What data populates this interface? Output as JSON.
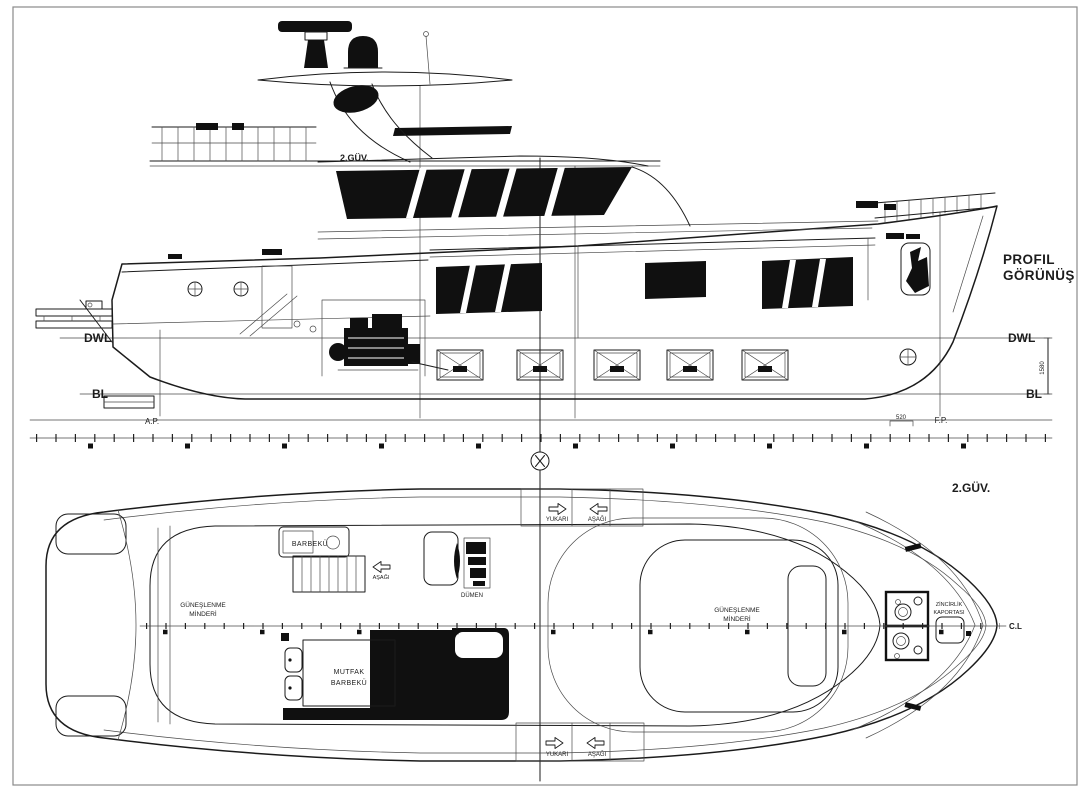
{
  "profile": {
    "title_line1": "PROFIL",
    "title_line2": "GÖRÜNÜŞ",
    "deck2_label": "2.GÜV.",
    "dwl_left": "DWL",
    "dwl_right": "DWL",
    "bl_left": "BL",
    "bl_right": "BL",
    "ap_label": "A.P.",
    "fp_label": "F.P.",
    "dim_forward": "520",
    "dim_depth": "1580"
  },
  "plan": {
    "deck2_label": "2.GÜV.",
    "centerline_label": "C.L",
    "sunpad_aft_line1": "GÜNEŞLENME",
    "sunpad_aft_line2": "MİNDERİ",
    "sunpad_fwd_line1": "GÜNEŞLENME",
    "sunpad_fwd_line2": "MİNDERİ",
    "barbecue_label": "BARBEKÜ",
    "galley_line1": "MUTFAK",
    "galley_line2": "BARBEKÜ",
    "helm_label": "DÜMEN",
    "chain_locker_line1": "ZİNCİRLİK",
    "chain_locker_line2": "KAPORTASI",
    "hatch_top_up": "YUKARI",
    "hatch_top_down": "AŞAĞI",
    "hatch_bottom_up": "YUKARI",
    "hatch_bottom_down": "AŞAĞI",
    "ladder_down_label": "AŞAĞI"
  },
  "colors": {
    "line": "#1b1b1b",
    "thin_line": "#4a4a4a",
    "background": "#ffffff",
    "border": "#8a8a8a"
  }
}
